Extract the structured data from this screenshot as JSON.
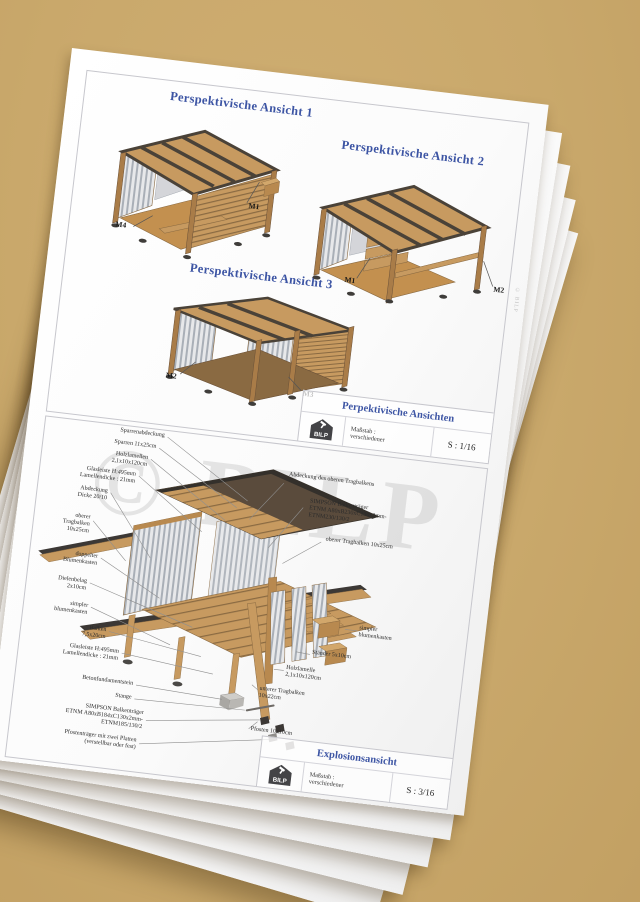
{
  "desk": {
    "background_color": "#c9a86b",
    "paper_color": "#fcfcfc"
  },
  "colors": {
    "accent_blue": "#3d55a4",
    "wood_light": "#c79a60",
    "wood_mid": "#b8894f",
    "wood_dark": "#8a6a42",
    "roof_dark": "#5a4b3c",
    "cap_dark": "#3c3835",
    "leader_line": "#8f8f8f"
  },
  "sheet": {
    "edge_watermark": "© BILP",
    "views_section": {
      "views": [
        {
          "title": "Perspektivische Ansicht 1",
          "markers": [
            "M4",
            "M1"
          ]
        },
        {
          "title": "Perspektivische Ansicht 2",
          "markers": [
            "M1",
            "M2"
          ]
        },
        {
          "title": "Perspektivische Ansicht 3",
          "markers": [
            "M2",
            "M3"
          ]
        }
      ],
      "title_block": {
        "title": "Perpektivische Ansichten",
        "logo_text": "BILP",
        "scale_label": "Maßstab :",
        "scale_value": "verschiedener",
        "sheet_number": "S : 1/16"
      }
    },
    "exploded_section": {
      "watermark": "© BILP",
      "labels_left": [
        "Sparrenabdeckung",
        "Sparren 11x25cm",
        "Holzlamellen\n2,1x10x120cm",
        "Glasleiste H:495mm\nLamellendicke : 21mm",
        "Abdeckung\nDicke 20/10",
        "oberer\nTragbalken\n10x25cm",
        "doppelter\nBlumenkasten",
        "Dielenbelag\n2x10cm",
        "simpler\nblumenkasten",
        "Balken\n7,5x20cm",
        "Glasleiste H:495mm\nLamellendicke : 21mm",
        "Betonfundamentstein",
        "Stange",
        "SIMPSON Balkenträger\nETNM A80xB184xC130x2mm-\nETNM185/130/2",
        "Pfostenträger mit zwei Platten\n(verstellbar oder fest)"
      ],
      "labels_right": [
        "Abdeckung des oberen Tragbalkens",
        "SIMPSON Balkenträger\nETNM A80xB230xC130x2mm-\nETNM230/130/2",
        "oberer Tragbalken 10x25cm",
        "simpler\nblumenkasten",
        "Ständer 5x10cm",
        "Holzlamelle\n2,1x10x120cm",
        "unterer Tragbalken\n10x22cm",
        "Pfosten 10x10cm"
      ],
      "title_block": {
        "title": "Explosionsansicht",
        "logo_text": "BILP",
        "scale_label": "Maßstab :",
        "scale_value": "verschiedener",
        "sheet_number": "S : 3/16"
      }
    }
  }
}
